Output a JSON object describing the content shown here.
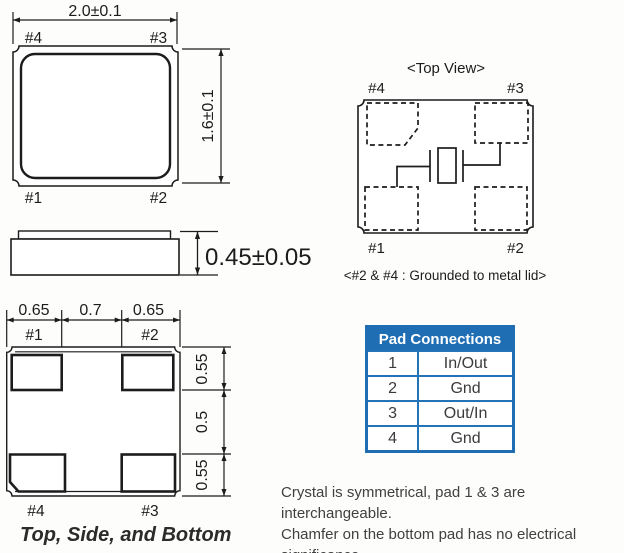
{
  "top_view": {
    "width_dim": "2.0±0.1",
    "height_dim": "1.6±0.1",
    "labels": {
      "tl": "#4",
      "tr": "#3",
      "bl": "#1",
      "br": "#2"
    }
  },
  "side_view": {
    "height_dim": "0.45±0.05"
  },
  "bottom_view": {
    "h_dims": [
      "0.65",
      "0.7",
      "0.65"
    ],
    "v_dims": [
      "0.55",
      "0.5",
      "0.55"
    ],
    "labels": {
      "tl": "#1",
      "tr": "#2",
      "bl": "#4",
      "br": "#3"
    },
    "caption": "Top, Side, and Bottom"
  },
  "schematic": {
    "title": "<Top View>",
    "labels": {
      "tl": "#4",
      "tr": "#3",
      "bl": "#1",
      "br": "#2"
    },
    "note": "<#2 & #4 : Grounded to metal lid>"
  },
  "pad_table": {
    "title": "Pad Connections",
    "rows": [
      {
        "pad": "1",
        "connection": "In/Out"
      },
      {
        "pad": "2",
        "connection": "Gnd"
      },
      {
        "pad": "3",
        "connection": "Out/In"
      },
      {
        "pad": "4",
        "connection": "Gnd"
      }
    ]
  },
  "footnote": {
    "lines": [
      "Crystal is symmetrical, pad 1 & 3 are interchangeable.",
      "Chamfer on the bottom pad has no electrical",
      "significance."
    ]
  },
  "colors": {
    "drawing_line": "#1c1c1c",
    "table_header_bg": "#1f6eb4",
    "table_border": "#2473b7",
    "table_text": "#3b3b3b",
    "footnote_text": "#404040"
  }
}
